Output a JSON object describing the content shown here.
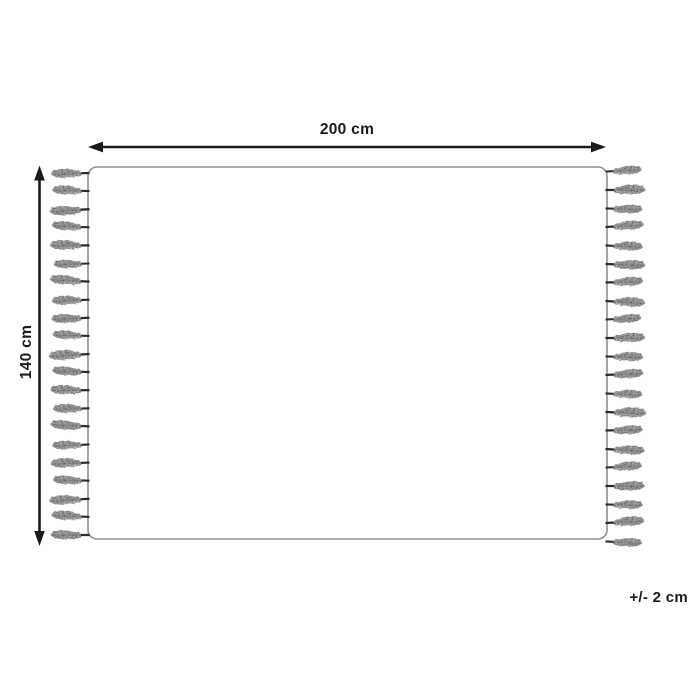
{
  "diagram": {
    "name": "Rug dimension diagram",
    "width_dimension": {
      "label": "200 cm"
    },
    "height_dimension": {
      "label": "140 cm"
    },
    "tolerance_note": {
      "label": "+/- 2 cm"
    },
    "fringe": {
      "tassels_left": 21,
      "tassels_right": 21
    },
    "colors": {
      "background": "#ffffff",
      "outline": "#8f8f8f",
      "arrow": "#1a1a1a",
      "text": "#1b1b1b",
      "tassel_body": "#3f3f3f",
      "tassel_stem": "#2c2c2c",
      "tassel_highlight": "#8a8a8a"
    }
  }
}
